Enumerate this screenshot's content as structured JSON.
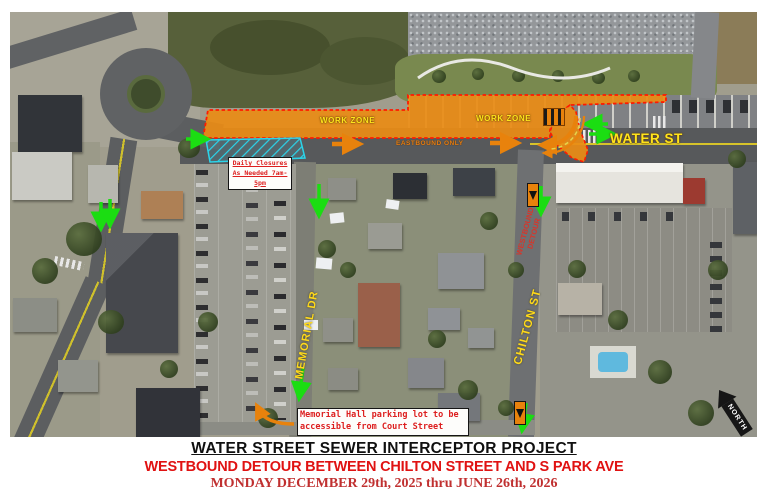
{
  "map": {
    "labels": {
      "work_zone_west": "WORK ZONE",
      "work_zone_east": "WORK ZONE",
      "eastbound_only": "EASTBOUND ONLY",
      "water_st": "WATER ST",
      "memorial_dr": "MEMORIAL DR",
      "chilton_st": "CHILTON ST",
      "westbound_detour_line1": "WESTBOUND",
      "westbound_detour_line2": "DETOUR",
      "north": "NORTH"
    },
    "callouts": {
      "daily_closures_line1": "Daily Closures",
      "daily_closures_line2": "As Needed 7am-5pm",
      "memorial_hall_line1": "Memorial Hall parking lot to be",
      "memorial_hall_line2": "accessible from Court Street"
    },
    "icons": {
      "detour_sign": "down-arrow-icon",
      "north_arrow": "north-arrow-icon",
      "green_arrows": "detour-route-arrow-icon",
      "orange_arrows": "eastbound-flow-arrow-icon"
    },
    "colors": {
      "work_zone_fill": "#EA8C15",
      "work_zone_border": "#FF1A00",
      "zone_label_yellow": "#FFE41C",
      "street_label_yellow": "#FFD91A",
      "detour_text_red": "#D8352A",
      "arrow_green": "#1BDD12",
      "arrow_orange": "#E8820C",
      "closure_hatch_cyan": "#2BD4EA",
      "callout_text_red": "#DD1F1F"
    }
  },
  "footer": {
    "title": "WATER STREET SEWER INTERCEPTOR PROJECT",
    "subtitle": "WESTBOUND DETOUR BETWEEN CHILTON STREET AND S PARK AVE",
    "date_range": "MONDAY DECEMBER 29th, 2025 thru JUNE 26th, 2026"
  }
}
